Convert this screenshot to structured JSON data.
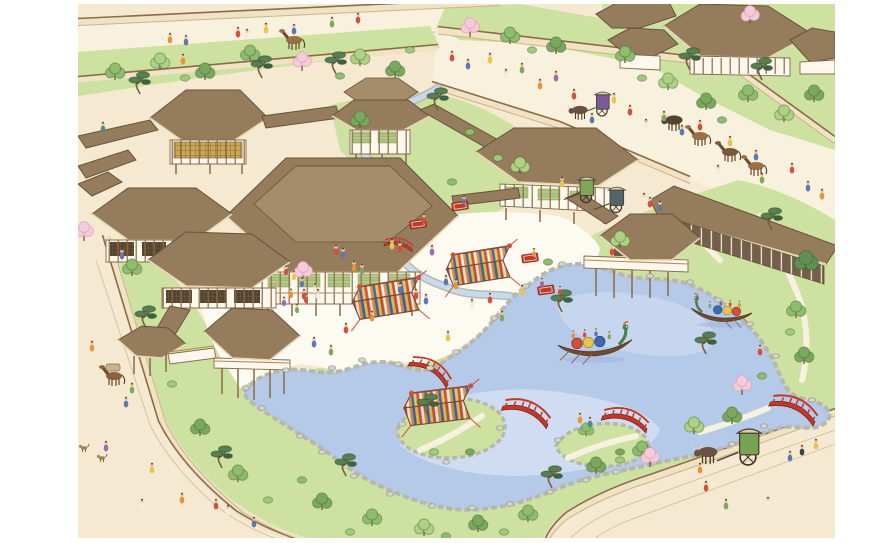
{
  "scene": {
    "title": "Bird's-eye watercolor illustration of a Heian-period shinden-zukuri palace with garden pond festival",
    "description": "Aerial view of an aristocratic Japanese residence: brown-roofed halls linked by corridors around a white sand courtyard, striped festival tents, a winding stream, a large pond with islands, red arched bridges, dragon-prowed pleasure boats, surrounding earthen walls, roads with courtiers, horses and ox-drawn carriages, pines and blossoming cherry trees.",
    "elements": [
      "main-hall",
      "northwest-hall",
      "north-pavilion",
      "east-hall",
      "east-long-hall",
      "pond-pavilion",
      "fishing-pavilion",
      "west-wing",
      "west-annex",
      "chumon-gate",
      "corridors",
      "white-courtyard",
      "striped-tents",
      "winding-stream",
      "garden-pond",
      "islands",
      "red-bridges",
      "dragon-boats",
      "ox-carts",
      "horses",
      "courtiers",
      "pine-trees",
      "cherry-trees",
      "earthen-walls",
      "roads",
      "neighbor-estate"
    ]
  },
  "palette": {
    "paper": "#ffffff",
    "ground": "#f5ead1",
    "road": "#f8f1dd",
    "roadLine": "#d2c09a",
    "grass": "#cde2a0",
    "grassLight": "#ddeab8",
    "pond": "#b5c9e8",
    "pondLight": "#d3dff3",
    "pondDeep": "#9bb4dc",
    "shore": "#b7b7ac",
    "rock": "#d4d4ca",
    "rockLine": "#96968c",
    "roof": "#947c5c",
    "roofLight": "#a58d6c",
    "roofLine": "#685339",
    "eave": "#ead9b6",
    "timber": "#8a6a48",
    "wallFace": "#fcf8ee",
    "wallDark": "#74604a",
    "courtyard": "#fdfaf2",
    "wallBand": "#f0e2c2",
    "wallCap": "#8a6b4a",
    "wallFoot": "#c9b48c",
    "bridge": "#c2392a",
    "stream": "#c6d9ef",
    "streamBank": "#b9b9ae",
    "tentRed": "#d5503a",
    "tentOrange": "#e69238",
    "tentYellow": "#e8c64c",
    "tentBlue": "#3f68ae",
    "tentWhite": "#f7f3e8",
    "treeGreen": "#8fbc6e",
    "treeLight": "#aed184",
    "pine": "#587f4f",
    "pineDark": "#3f6340",
    "cherry": "#f4cbd9",
    "trunk": "#7d5c3c",
    "skin": "#ecc9a2",
    "hair": "#3a3230",
    "dragonGreen": "#4a7d48",
    "hull": "#6f4c33"
  },
  "figure_colors": [
    "#d5503a",
    "#e8923c",
    "#e8c64c",
    "#5d77b4",
    "#7ea85e",
    "#f2ede2",
    "#9a6bb0",
    "#4e8e8a",
    "#3f3f3f"
  ]
}
